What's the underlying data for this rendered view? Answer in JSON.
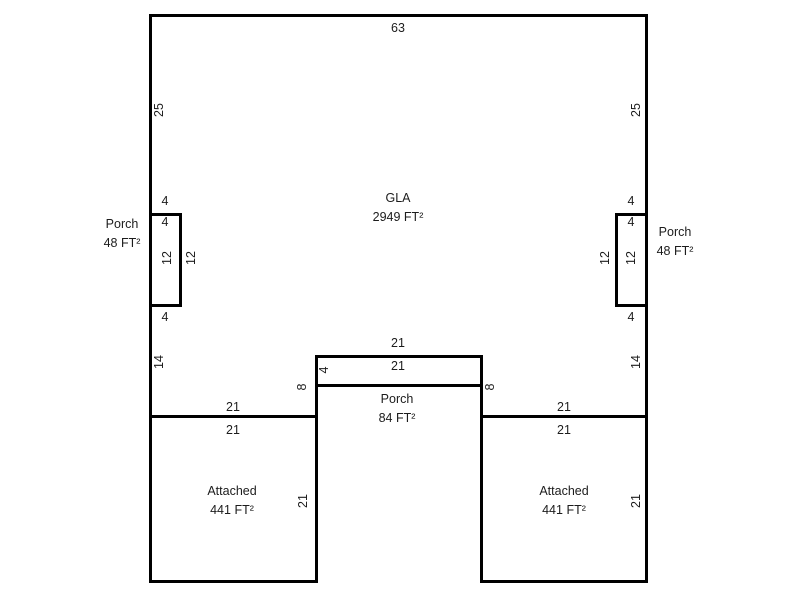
{
  "sketch": {
    "background_color": "#ffffff",
    "line_color": "#000000",
    "text_color": "#1c1c1c",
    "areas": [
      {
        "id": "gla",
        "name": "GLA",
        "size": "2949 FT²",
        "cx": 398,
        "cy": 208
      },
      {
        "id": "left-porch",
        "name": "Porch",
        "size": "48 FT²",
        "cx": 122,
        "cy": 234
      },
      {
        "id": "right-porch",
        "name": "Porch",
        "size": "48 FT²",
        "cx": 675,
        "cy": 242
      },
      {
        "id": "bottom-porch",
        "name": "Porch",
        "size": "84 FT²",
        "cx": 397,
        "cy": 409
      },
      {
        "id": "left-garage",
        "name": "Attached",
        "size": "441 FT²",
        "cx": 232,
        "cy": 501
      },
      {
        "id": "right-garage",
        "name": "Attached",
        "size": "441 FT²",
        "cx": 564,
        "cy": 501
      }
    ],
    "dimensions": [
      {
        "text": "63",
        "cx": 398,
        "cy": 28,
        "rotated": false
      },
      {
        "text": "25",
        "cx": 159,
        "cy": 110,
        "rotated": true
      },
      {
        "text": "25",
        "cx": 636,
        "cy": 110,
        "rotated": true
      },
      {
        "text": "4",
        "cx": 165,
        "cy": 201,
        "rotated": false
      },
      {
        "text": "4",
        "cx": 165,
        "cy": 222,
        "rotated": false
      },
      {
        "text": "12",
        "cx": 167,
        "cy": 258,
        "rotated": true
      },
      {
        "text": "12",
        "cx": 191,
        "cy": 258,
        "rotated": true
      },
      {
        "text": "4",
        "cx": 165,
        "cy": 317,
        "rotated": false
      },
      {
        "text": "4",
        "cx": 631,
        "cy": 201,
        "rotated": false
      },
      {
        "text": "4",
        "cx": 631,
        "cy": 222,
        "rotated": false
      },
      {
        "text": "12",
        "cx": 631,
        "cy": 258,
        "rotated": true
      },
      {
        "text": "12",
        "cx": 605,
        "cy": 258,
        "rotated": true
      },
      {
        "text": "4",
        "cx": 631,
        "cy": 317,
        "rotated": false
      },
      {
        "text": "14",
        "cx": 159,
        "cy": 362,
        "rotated": true
      },
      {
        "text": "14",
        "cx": 636,
        "cy": 362,
        "rotated": true
      },
      {
        "text": "21",
        "cx": 398,
        "cy": 343,
        "rotated": false
      },
      {
        "text": "21",
        "cx": 398,
        "cy": 366,
        "rotated": false
      },
      {
        "text": "4",
        "cx": 324,
        "cy": 370,
        "rotated": true
      },
      {
        "text": "8",
        "cx": 302,
        "cy": 387,
        "rotated": true
      },
      {
        "text": "8",
        "cx": 490,
        "cy": 387,
        "rotated": true
      },
      {
        "text": "21",
        "cx": 233,
        "cy": 407,
        "rotated": false
      },
      {
        "text": "21",
        "cx": 233,
        "cy": 430,
        "rotated": false
      },
      {
        "text": "21",
        "cx": 303,
        "cy": 501,
        "rotated": true
      },
      {
        "text": "21",
        "cx": 564,
        "cy": 407,
        "rotated": false
      },
      {
        "text": "21",
        "cx": 564,
        "cy": 430,
        "rotated": false
      },
      {
        "text": "21",
        "cx": 636,
        "cy": 501,
        "rotated": true
      }
    ],
    "outlines": [
      {
        "id": "left-porch-outline",
        "x": 149,
        "y": 213,
        "w": 33,
        "h": 94
      },
      {
        "id": "right-porch-outline",
        "x": 615,
        "y": 213,
        "w": 33,
        "h": 94
      },
      {
        "id": "bottom-porch-outline",
        "x": 315,
        "y": 355,
        "w": 168,
        "h": 32
      }
    ],
    "walls": [
      {
        "id": "top-wall",
        "x": 149,
        "y": 14,
        "len": 499,
        "dir": "h"
      },
      {
        "id": "left-wall",
        "x": 149,
        "y": 14,
        "len": 569,
        "dir": "v"
      },
      {
        "id": "right-wall",
        "x": 645,
        "y": 14,
        "len": 569,
        "dir": "v"
      },
      {
        "id": "main-bottom-left-wall",
        "x": 149,
        "y": 415,
        "len": 168,
        "dir": "h"
      },
      {
        "id": "main-bottom-right-wall",
        "x": 480,
        "y": 415,
        "len": 168,
        "dir": "h"
      },
      {
        "id": "left-garage-bottom-wall",
        "x": 149,
        "y": 580,
        "len": 168,
        "dir": "h"
      },
      {
        "id": "right-garage-bottom-wall",
        "x": 480,
        "y": 580,
        "len": 168,
        "dir": "h"
      },
      {
        "id": "gap-left-wall",
        "x": 315,
        "y": 355,
        "len": 228,
        "dir": "v"
      },
      {
        "id": "gap-right-wall",
        "x": 480,
        "y": 355,
        "len": 228,
        "dir": "v"
      }
    ]
  }
}
